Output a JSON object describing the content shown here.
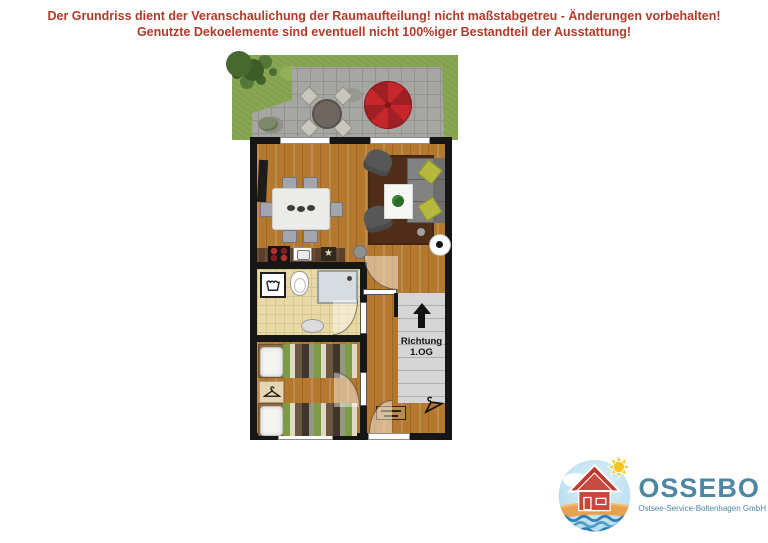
{
  "disclaimer": {
    "line1": "Der Grundriss dient der Veranschaulichung der Raumaufteilung! nicht maßstabgetreu - Änderungen vorbehalten!",
    "line2": "Genutzte Dekoelemente sind eventuell nicht 100%iger Bestandteil der Ausstattung!"
  },
  "floorplan": {
    "stairs": {
      "line1": "Richtung",
      "line2": "1.OG"
    },
    "kitchen": {
      "star_glyph": "★"
    }
  },
  "logo": {
    "name": "OSSEBO",
    "tagline": "Ostsee-Service-Boltenhagen GmbH"
  },
  "colors": {
    "disclaimer_text": "#b23a28",
    "walls": "#161616",
    "wood_floor": "#b5782f",
    "bath_tiles": "#e9d9a6",
    "grass": "#84a24e",
    "terrace": "#a6a6a2",
    "parasol": "#c5272b",
    "logo_teal": "#4e87a2"
  }
}
